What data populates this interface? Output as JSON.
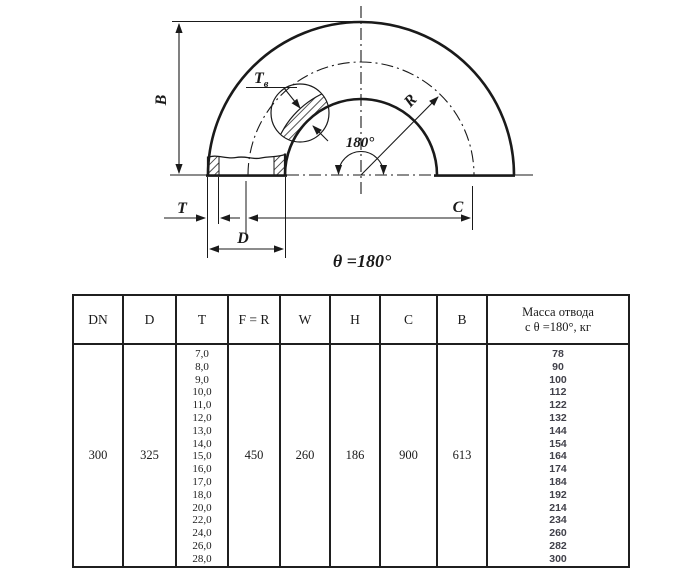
{
  "diagram": {
    "caption": "θ =180°",
    "labels": {
      "b": "B",
      "tb_main": "T",
      "tb_sub": "в",
      "r": "R",
      "angle": "180°",
      "t": "T",
      "c": "C",
      "d": "D"
    }
  },
  "table": {
    "headers": {
      "dn": "DN",
      "d": "D",
      "t": "T",
      "fr": "F = R",
      "w": "W",
      "h": "H",
      "c": "C",
      "b": "B",
      "mass_line1": "Масса отвода",
      "mass_line2": "с θ =180°, кг"
    },
    "row": {
      "dn": "300",
      "d": "325",
      "fr": "450",
      "w": "260",
      "h": "186",
      "c": "900",
      "b": "613"
    },
    "t_values": [
      "7,0",
      "8,0",
      "9,0",
      "10,0",
      "11,0",
      "12,0",
      "13,0",
      "14,0",
      "15,0",
      "16,0",
      "17,0",
      "18,0",
      "20,0",
      "22,0",
      "24,0",
      "26,0",
      "28,0"
    ],
    "mass_values": [
      "78",
      "90",
      "100",
      "112",
      "122",
      "132",
      "144",
      "154",
      "164",
      "174",
      "184",
      "192",
      "214",
      "234",
      "260",
      "282",
      "300"
    ]
  },
  "colors": {
    "line": "#1a1a1a",
    "mass_text": "#41414a"
  }
}
